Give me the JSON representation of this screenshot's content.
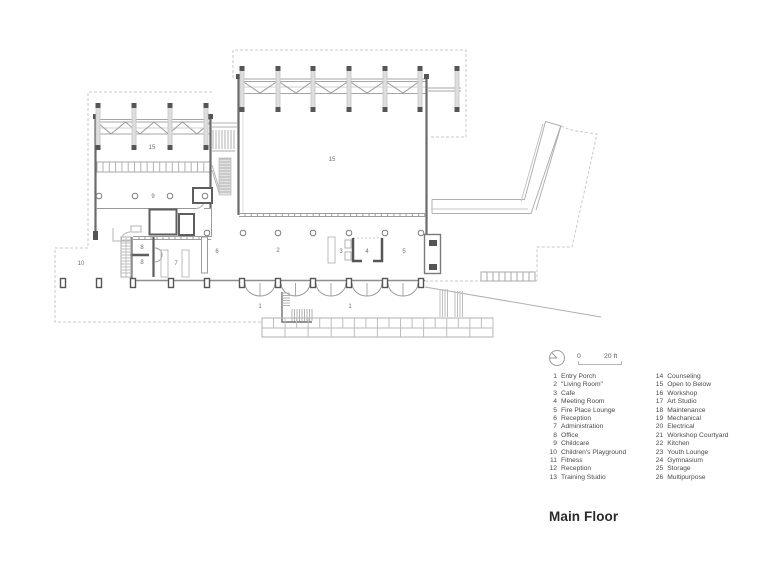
{
  "sheet": {
    "title": "Main Floor"
  },
  "colors": {
    "line": "#adadad",
    "wall": "#6a6a6a",
    "dashed": "#c9c9c9",
    "dark_fill": "#555555",
    "text": "#595959",
    "title": "#2b2b2b"
  },
  "scale_bar": {
    "zero": "0",
    "twenty": "20 ft",
    "icon": "north-arrow-icon"
  },
  "legend": {
    "col1": [
      {
        "n": "1",
        "label": "Entry Porch"
      },
      {
        "n": "2",
        "label": "\"Living Room\""
      },
      {
        "n": "3",
        "label": "Cafe"
      },
      {
        "n": "4",
        "label": "Meeting Room"
      },
      {
        "n": "5",
        "label": "Fire Place Lounge"
      },
      {
        "n": "6",
        "label": "Reception"
      },
      {
        "n": "7",
        "label": "Administration"
      },
      {
        "n": "8",
        "label": "Office"
      },
      {
        "n": "9",
        "label": "Childcare"
      },
      {
        "n": "10",
        "label": "Children's Playground"
      },
      {
        "n": "11",
        "label": "Fitness"
      },
      {
        "n": "12",
        "label": "Reception"
      },
      {
        "n": "13",
        "label": "Training Studio"
      }
    ],
    "col2": [
      {
        "n": "14",
        "label": "Counseling"
      },
      {
        "n": "15",
        "label": "Open to Below"
      },
      {
        "n": "16",
        "label": "Workshop"
      },
      {
        "n": "17",
        "label": "Art Studio"
      },
      {
        "n": "18",
        "label": "Maintenance"
      },
      {
        "n": "19",
        "label": "Mechanical"
      },
      {
        "n": "20",
        "label": "Electrical"
      },
      {
        "n": "21",
        "label": "Workshop Courtyard"
      },
      {
        "n": "22",
        "label": "Kitchen"
      },
      {
        "n": "23",
        "label": "Youth Lounge"
      },
      {
        "n": "24",
        "label": "Gymnasium"
      },
      {
        "n": "25",
        "label": "Storage"
      },
      {
        "n": "26",
        "label": "Multipurpose"
      }
    ]
  },
  "plan": {
    "room_labels": [
      {
        "n": "15",
        "x": 152,
        "y": 149
      },
      {
        "n": "9",
        "x": 153,
        "y": 198
      },
      {
        "n": "15",
        "x": 332,
        "y": 161
      },
      {
        "n": "8",
        "x": 142,
        "y": 249
      },
      {
        "n": "8",
        "x": 142,
        "y": 264
      },
      {
        "n": "7",
        "x": 176,
        "y": 265
      },
      {
        "n": "6",
        "x": 217,
        "y": 253
      },
      {
        "n": "2",
        "x": 278,
        "y": 252
      },
      {
        "n": "3",
        "x": 341,
        "y": 253
      },
      {
        "n": "4",
        "x": 367,
        "y": 253
      },
      {
        "n": "5",
        "x": 404,
        "y": 253
      },
      {
        "n": "10",
        "x": 81,
        "y": 265
      },
      {
        "n": "1",
        "x": 260,
        "y": 308
      },
      {
        "n": "1",
        "x": 350,
        "y": 308
      }
    ]
  }
}
